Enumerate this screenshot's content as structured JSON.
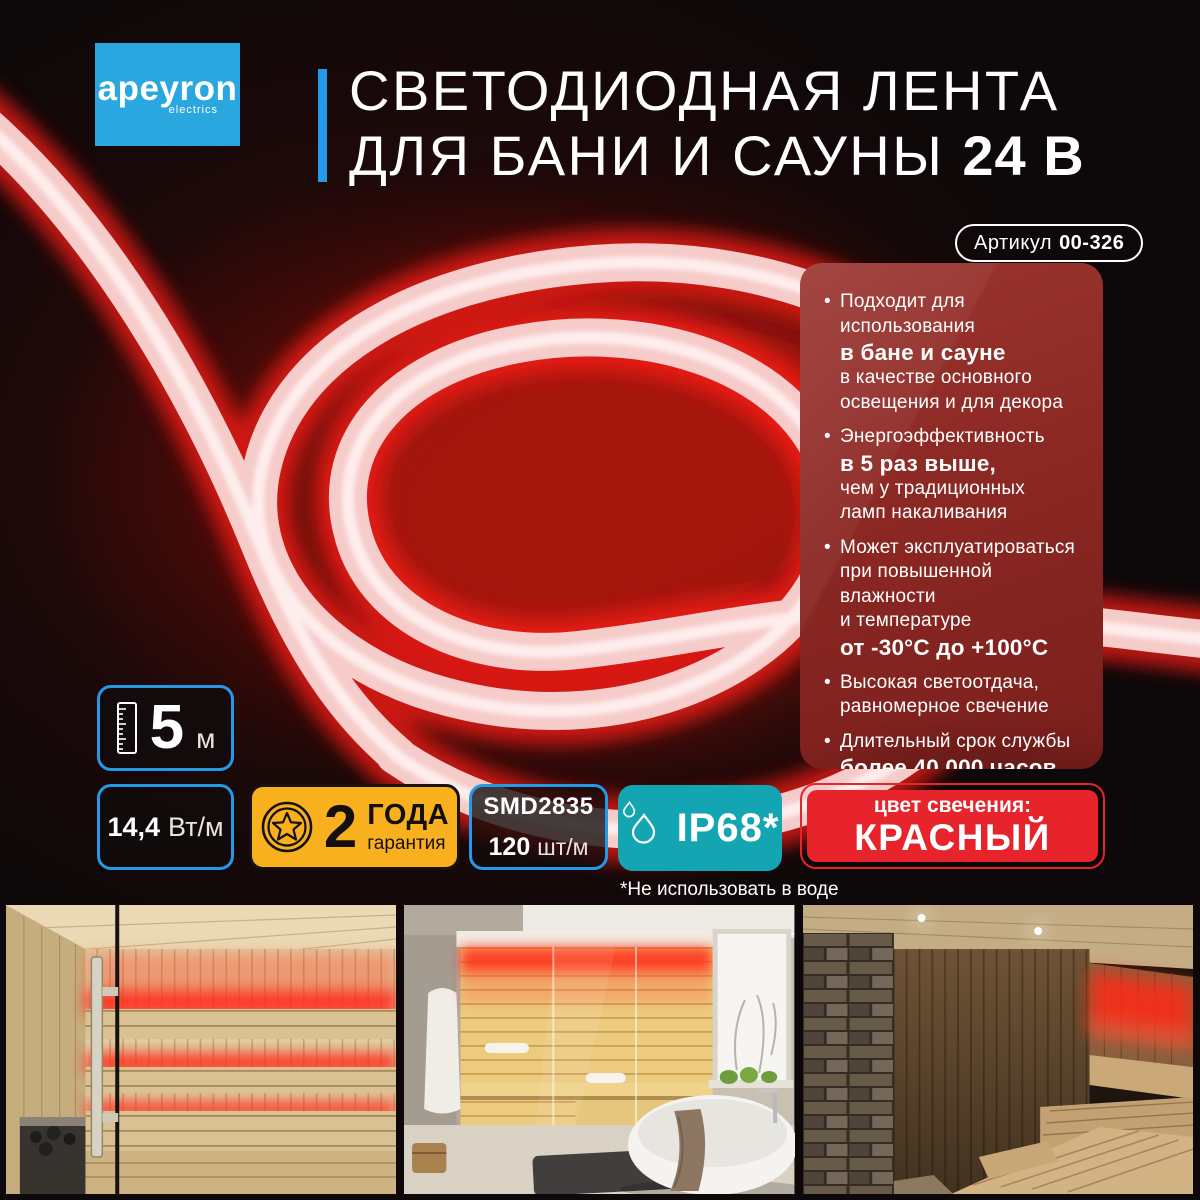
{
  "brand": {
    "name": "apeyron",
    "tagline": "electrics"
  },
  "header": {
    "title_line1": "СВЕТОДИОДНАЯ ЛЕНТА",
    "title_line2": "ДЛЯ БАНИ И САУНЫ",
    "title_voltage": "24 В"
  },
  "article_badge": {
    "label": "Артикул",
    "value": "00-326"
  },
  "features": {
    "f1": {
      "l1": "Подходит для использования",
      "l2": "в бане и сауне",
      "l3": "в качестве основного",
      "l4": "освещения и для декора"
    },
    "f2": {
      "l1": "Энергоэффективность",
      "l2": "в 5 раз выше,",
      "l3": "чем у традиционных",
      "l4": "ламп накаливания"
    },
    "f3": {
      "l1": "Может эксплуатироваться",
      "l2": "при повышенной влажности",
      "l3": "и температуре",
      "l4": "от -30°С до +100°С"
    },
    "f4": {
      "l1": "Высокая светоотдача,",
      "l2": "равномерное свечение"
    },
    "f5": {
      "l1": "Длительный срок службы",
      "l2": "более 40 000 часов"
    },
    "f6": {
      "l1": "Простота монтажа"
    }
  },
  "badges": {
    "length": {
      "value": "5",
      "unit": "м",
      "icon": "ruler-icon"
    },
    "power": {
      "value": "14,4",
      "unit": "Вт/м"
    },
    "warranty": {
      "value": "2",
      "label_top": "ГОДА",
      "label_bottom": "гарантия",
      "icon": "star-medal-icon"
    },
    "led": {
      "model": "SMD2835",
      "density_value": "120",
      "density_unit": "шт/м"
    },
    "protection": {
      "value": "IP68*",
      "icon": "water-drops-icon",
      "footnote": "*Не использовать в воде"
    },
    "color": {
      "label": "цвет свечения:",
      "value": "КРАСНЫЙ"
    }
  },
  "colors": {
    "accent_blue": "#2598e8",
    "logo_blue": "#2aa7df",
    "panel_red": "#8c2823",
    "badge_yellow": "#f9b01f",
    "badge_cyan": "#13a6b2",
    "badge_red": "#e7232b",
    "glow_red": "#ff1e12"
  },
  "photos": [
    {
      "alt": "sauna-interior-red-led"
    },
    {
      "alt": "bathroom-sauna-red-led"
    },
    {
      "alt": "dark-sauna-red-led"
    }
  ]
}
